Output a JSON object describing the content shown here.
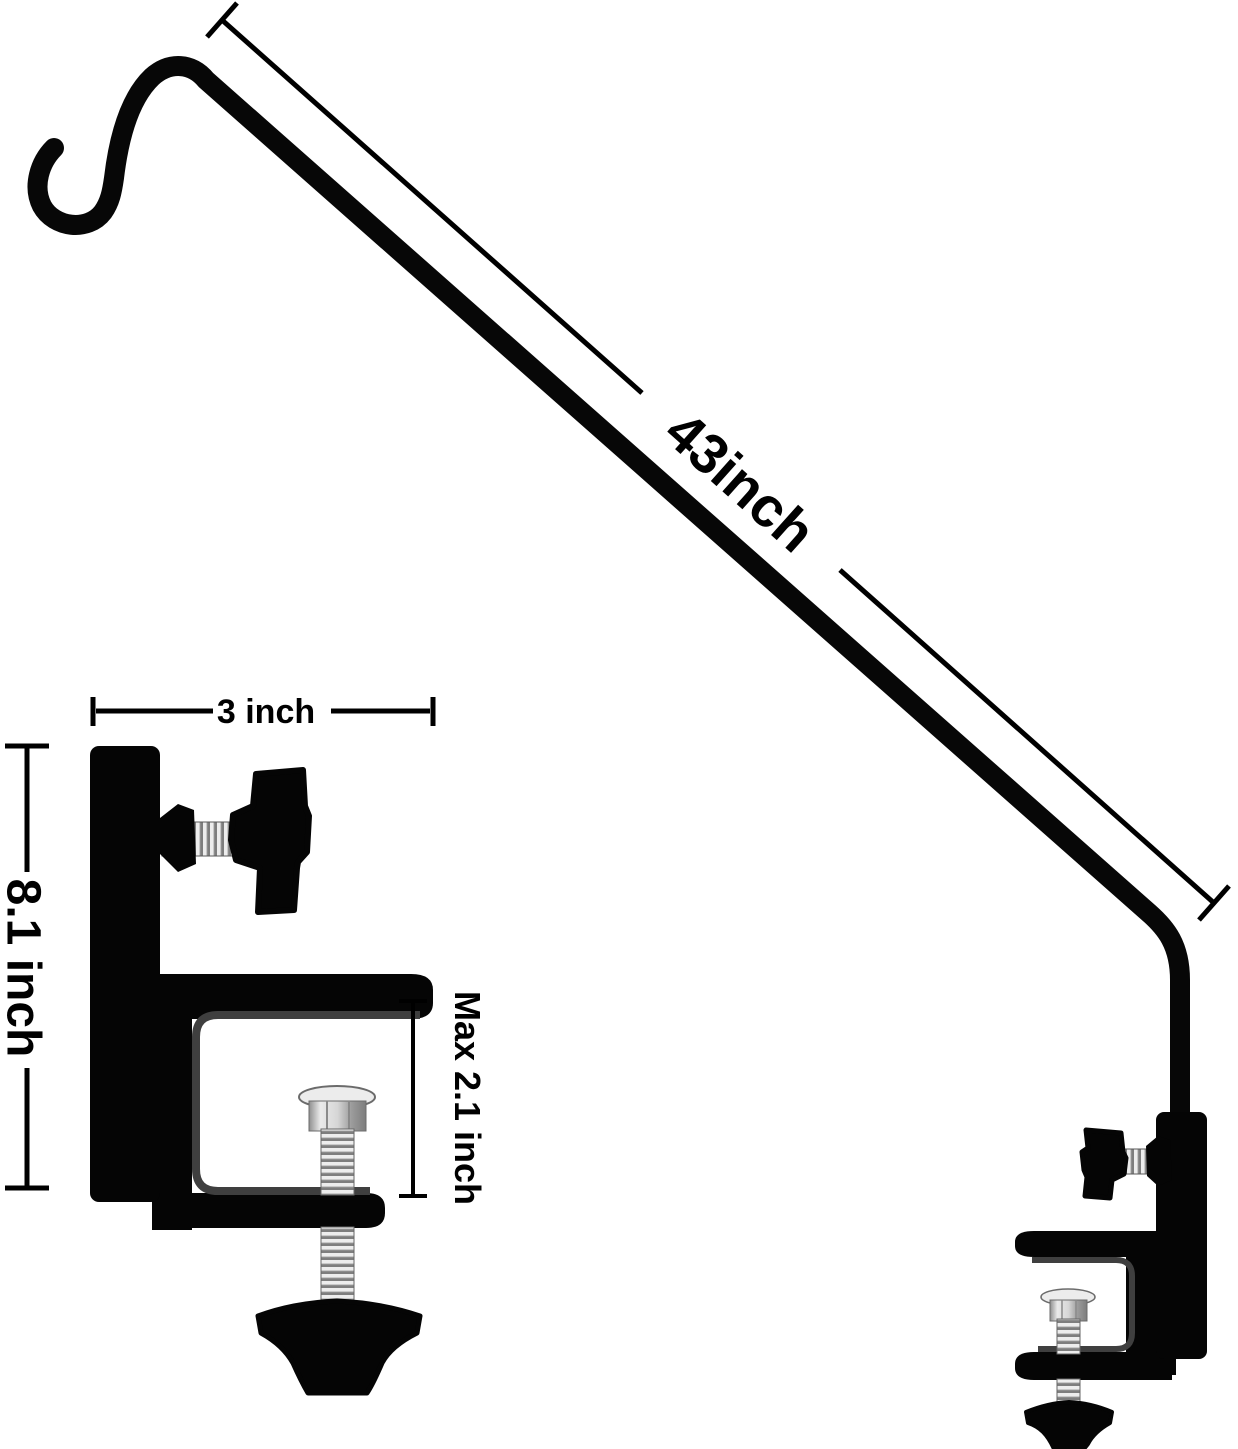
{
  "dims": {
    "pole_length": "43inch",
    "clamp_width": "3 inch",
    "clamp_height": "8.1 inch",
    "max_opening": "Max 2.1 inch"
  },
  "colors": {
    "background": "#ffffff",
    "product_black": "#070707",
    "steel_silver": "#c9c9c9",
    "dimension_text": "#000000"
  }
}
